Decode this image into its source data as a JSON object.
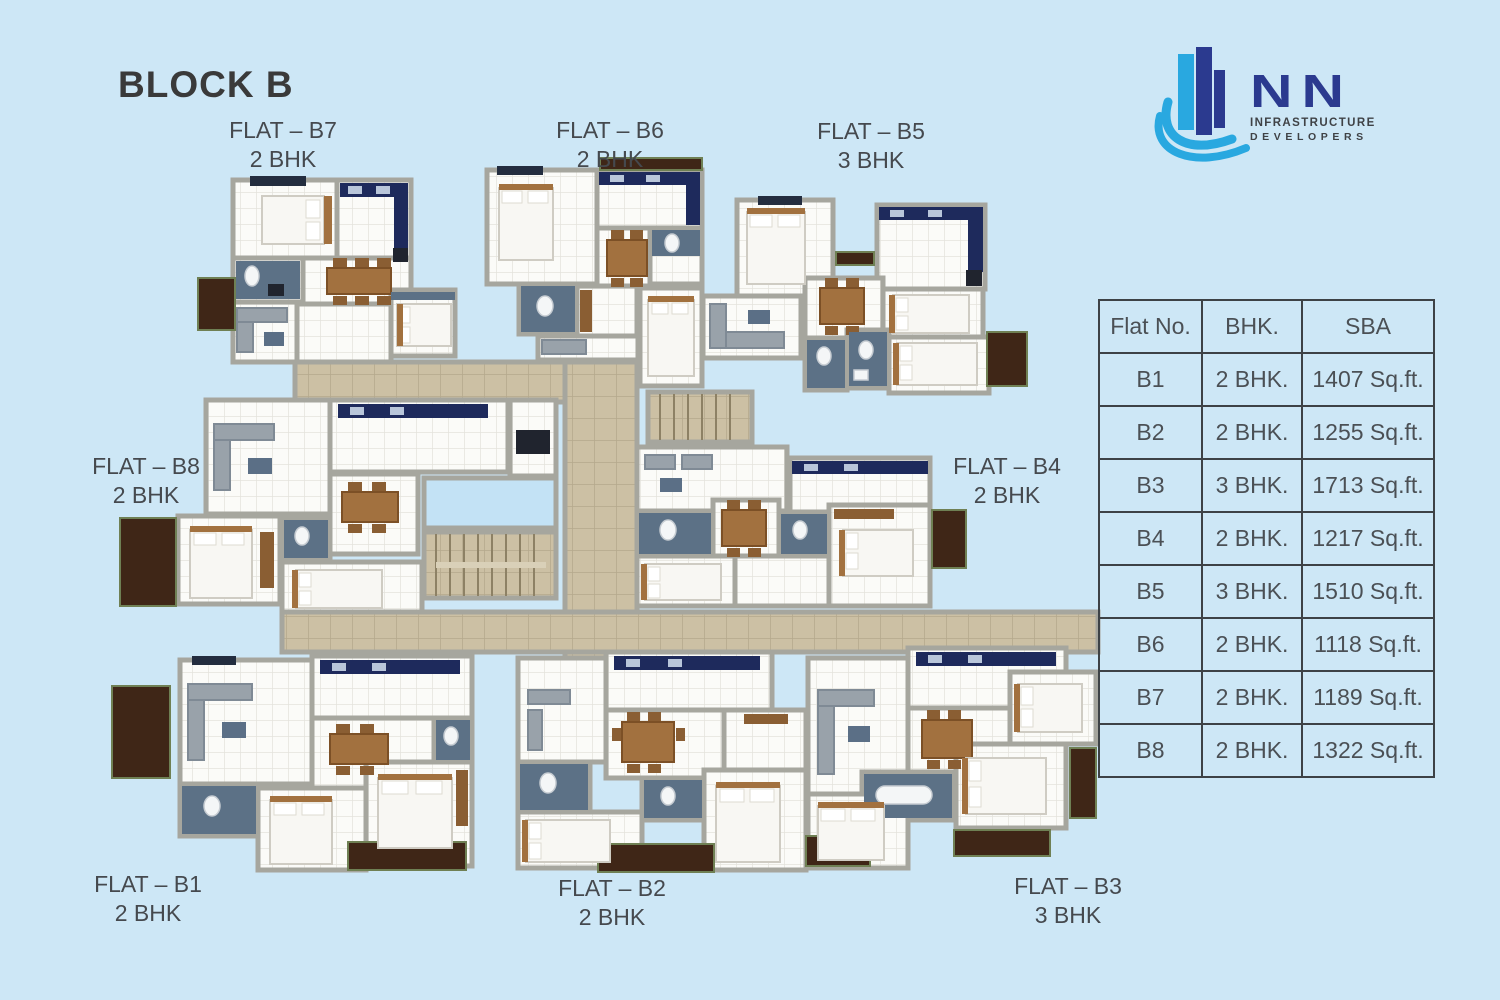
{
  "page": {
    "title": "BLOCK B"
  },
  "logo": {
    "company": "NN",
    "tagline1": "INFRASTRUCTURE",
    "tagline2": "DEVELOPERS"
  },
  "flat_labels": {
    "b7": {
      "name": "FLAT – B7",
      "type": "2 BHK"
    },
    "b6": {
      "name": "FLAT – B6",
      "type": "2 BHK"
    },
    "b5": {
      "name": "FLAT – B5",
      "type": "3 BHK"
    },
    "b8": {
      "name": "FLAT – B8",
      "type": "2 BHK"
    },
    "b4": {
      "name": "FLAT – B4",
      "type": "2 BHK"
    },
    "b1": {
      "name": "FLAT – B1",
      "type": "2 BHK"
    },
    "b2": {
      "name": "FLAT – B2",
      "type": "2 BHK"
    },
    "b3": {
      "name": "FLAT – B3",
      "type": "3 BHK"
    }
  },
  "table": {
    "headers": [
      "Flat No.",
      "BHK.",
      "SBA"
    ],
    "rows": [
      [
        "B1",
        "2 BHK.",
        "1407 Sq.ft."
      ],
      [
        "B2",
        "2 BHK.",
        "1255 Sq.ft."
      ],
      [
        "B3",
        "3 BHK.",
        "1713 Sq.ft."
      ],
      [
        "B4",
        "2 BHK.",
        "1217 Sq.ft."
      ],
      [
        "B5",
        "3 BHK.",
        "1510 Sq.ft."
      ],
      [
        "B6",
        "2 BHK.",
        "1118 Sq.ft."
      ],
      [
        "B7",
        "2 BHK.",
        "1189 Sq.ft."
      ],
      [
        "B8",
        "2 BHK.",
        "1322 Sq.ft."
      ]
    ]
  },
  "colors": {
    "background": "#cde7f6",
    "accent_blue": "#29a8e0",
    "brand_navy": "#2b3a8f",
    "title_dark": "#3a3a3a",
    "label_gray": "#45494e",
    "corridor_tan": "#ccc0a4",
    "bath_slate": "#5c7186",
    "kitchen_navy": "#1e2a5c",
    "wood": "#a2713f",
    "balcony_brown": "#3f2617"
  }
}
